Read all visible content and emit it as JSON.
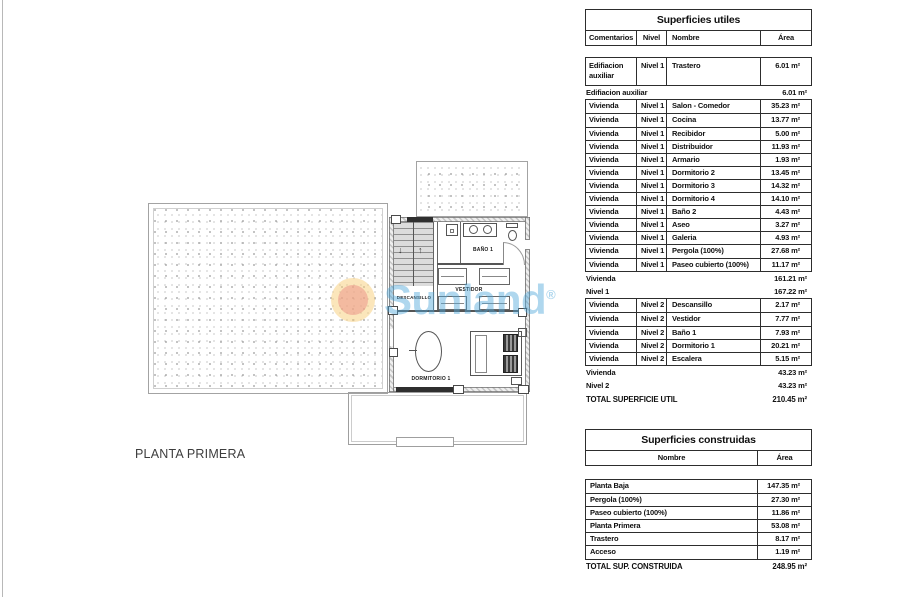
{
  "page": {
    "background": "#ffffff"
  },
  "plan": {
    "title": "PLANTA PRIMERA",
    "rooms": {
      "descansillo": "DESCANSILLO",
      "vestidor": "VESTIDOR",
      "bano": "BAÑO 1",
      "dormitorio": "DORMITORIO 1"
    },
    "stair_arrows": {
      "down": "↓",
      "up": "↑"
    },
    "watermark": {
      "brand": "Sunland",
      "registered": "®",
      "text_color": "rgba(77,166,217,0.45)",
      "sun_outer_color": "rgba(247,205,120,0.5)",
      "sun_inner_color": "rgba(236,150,138,0.55)"
    }
  },
  "tables": {
    "utiles": {
      "title": "Superficies utiles",
      "columns": [
        "Comentarios",
        "Nivel",
        "Nombre",
        "Área"
      ],
      "rows": [
        {
          "tall": true,
          "c": [
            "Edifiacion auxiliar",
            "Nivel 1",
            "Trastero",
            "6.01 m²"
          ]
        },
        {
          "l": "Edifiacion auxiliar",
          "v": "6.01 m²"
        },
        {
          "c": [
            "Vivienda",
            "Nivel 1",
            "Salon - Comedor",
            "35.23 m²"
          ]
        },
        {
          "c": [
            "Vivienda",
            "Nivel 1",
            "Cocina",
            "13.77 m²"
          ]
        },
        {
          "c": [
            "Vivienda",
            "Nivel 1",
            "Recibidor",
            "5.00 m²"
          ]
        },
        {
          "c": [
            "Vivienda",
            "Nivel 1",
            "Distribuidor",
            "11.93 m²"
          ]
        },
        {
          "c": [
            "Vivienda",
            "Nivel 1",
            "Armario",
            "1.93 m²"
          ]
        },
        {
          "c": [
            "Vivienda",
            "Nivel 1",
            "Dormitorio 2",
            "13.45 m²"
          ]
        },
        {
          "c": [
            "Vivienda",
            "Nivel 1",
            "Dormitorio 3",
            "14.32 m²"
          ]
        },
        {
          "c": [
            "Vivienda",
            "Nivel 1",
            "Dormitorio 4",
            "14.10 m²"
          ]
        },
        {
          "c": [
            "Vivienda",
            "Nivel 1",
            "Baño 2",
            "4.43 m²"
          ]
        },
        {
          "c": [
            "Vivienda",
            "Nivel 1",
            "Aseo",
            "3.27 m²"
          ]
        },
        {
          "c": [
            "Vivienda",
            "Nivel 1",
            "Galeria",
            "4.93 m²"
          ]
        },
        {
          "c": [
            "Vivienda",
            "Nivel 1",
            "Pergola (100%)",
            "27.68 m²"
          ]
        },
        {
          "c": [
            "Vivienda",
            "Nivel 1",
            "Paseo cubierto (100%)",
            "11.17 m²"
          ]
        },
        {
          "l": "Vivienda",
          "v": "161.21 m²"
        },
        {
          "l": "Nivel 1",
          "v": "167.22 m²"
        },
        {
          "c": [
            "Vivienda",
            "Nivel 2",
            "Descansillo",
            "2.17 m²"
          ]
        },
        {
          "c": [
            "Vivienda",
            "Nivel 2",
            "Vestidor",
            "7.77 m²"
          ]
        },
        {
          "c": [
            "Vivienda",
            "Nivel 2",
            "Baño 1",
            "7.93 m²"
          ]
        },
        {
          "c": [
            "Vivienda",
            "Nivel 2",
            "Dormitorio 1",
            "20.21 m²"
          ]
        },
        {
          "c": [
            "Vivienda",
            "Nivel 2",
            "Escalera",
            "5.15 m²"
          ]
        },
        {
          "l": "Vivienda",
          "v": "43.23 m²"
        },
        {
          "l": "Nivel 2",
          "v": "43.23 m²"
        },
        {
          "total": true,
          "l": "TOTAL SUPERFICIE UTIL",
          "v": "210.45 m²"
        }
      ]
    },
    "construidas": {
      "title": "Superficies construidas",
      "columns": [
        "Nombre",
        "Área"
      ],
      "rows": [
        {
          "c": [
            "Planta Baja",
            "147.35 m²"
          ]
        },
        {
          "c": [
            "Pergola (100%)",
            "27.30 m²"
          ]
        },
        {
          "c": [
            "Paseo cubierto (100%)",
            "11.86 m²"
          ]
        },
        {
          "c": [
            "Planta Primera",
            "53.08 m²"
          ]
        },
        {
          "c": [
            "Trastero",
            "8.17 m²"
          ]
        },
        {
          "c": [
            "Acceso",
            "1.19 m²"
          ]
        },
        {
          "total": true,
          "l": "TOTAL SUP. CONSTRUIDA",
          "v": "248.95 m²"
        }
      ]
    }
  }
}
